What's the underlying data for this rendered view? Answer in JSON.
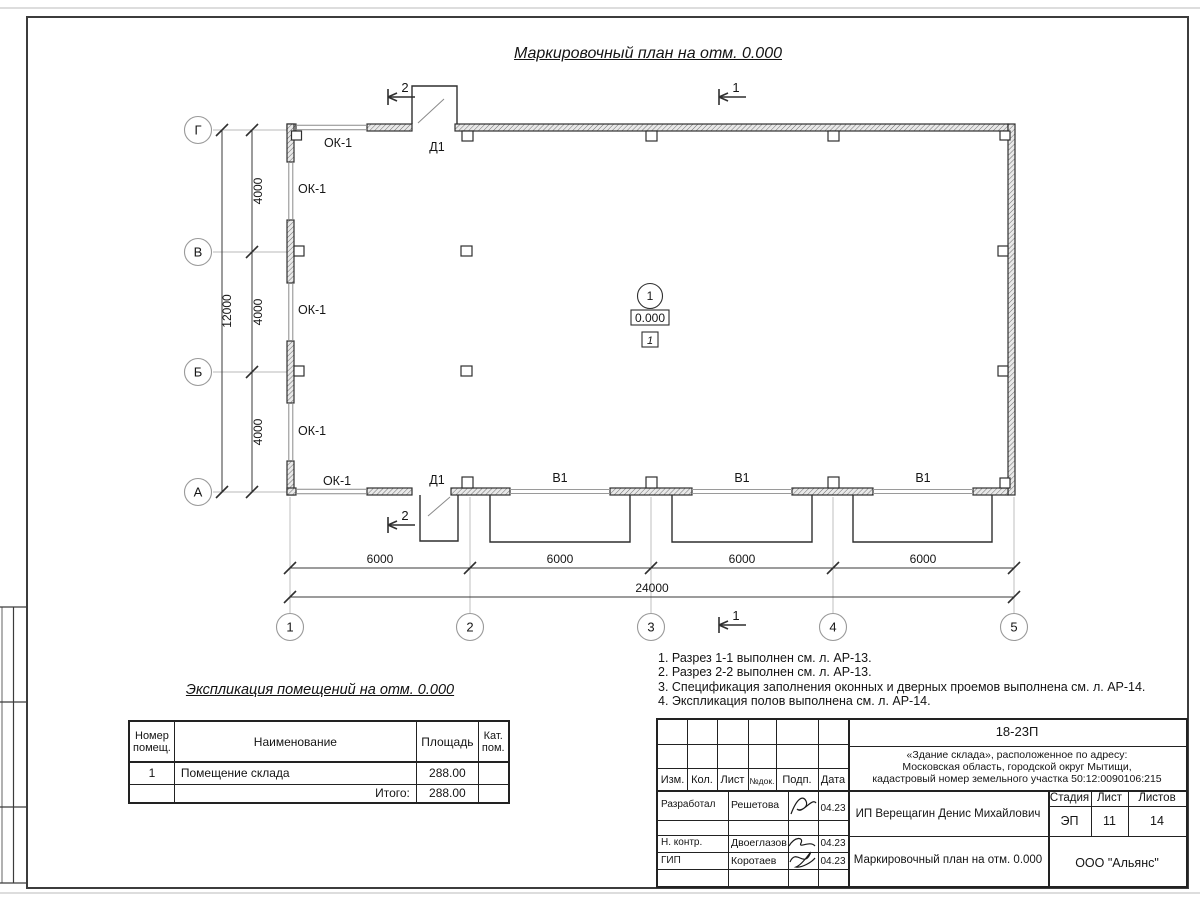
{
  "plan": {
    "title": "Маркировочный план на отм. 0.000",
    "axes_bottom": [
      "1",
      "2",
      "3",
      "4",
      "5"
    ],
    "axes_left": [
      "Г",
      "В",
      "Б",
      "А"
    ],
    "dims_bottom": [
      "6000",
      "6000",
      "6000",
      "6000"
    ],
    "dim_bottom_total": "24000",
    "dims_left": [
      "4000",
      "4000",
      "4000"
    ],
    "dim_left_total": "12000",
    "window_mark": "ОК-1",
    "door_mark": "Д1",
    "gate_mark": "В1",
    "section_mark_1": "1",
    "section_mark_2": "2",
    "room": {
      "number": "1",
      "elevation": "0.000",
      "floor_type": "1"
    }
  },
  "notes": {
    "lines": [
      "1. Разрез 1-1 выполнен см. л. АР-13.",
      "2. Разрез 2-2 выполнен см. л. АР-13.",
      "3. Спецификация заполнения оконных и дверных проемов выполнена см. л. АР-14.",
      "4. Экспликация полов выполнена см. л. АР-14."
    ]
  },
  "explication": {
    "title": "Экспликация помещений на отм. 0.000",
    "headers": {
      "number": "Номер\nпомещ.",
      "name": "Наименование",
      "area": "Площадь",
      "cat": "Кат.\nпом."
    },
    "rows": [
      {
        "number": "1",
        "name": "Помещение склада",
        "area": "288.00",
        "cat": ""
      }
    ],
    "total_label": "Итого:",
    "total_area": "288.00"
  },
  "titleblock": {
    "document_code": "18-23П",
    "object_lines": [
      "«Здание склада», расположенное по адресу:",
      "Московская область, городской округ Мытищи,",
      "кадастровый номер земельного участка 50:12:0090106:215"
    ],
    "revision_headers": [
      "Изм.",
      "Кол.",
      "Лист",
      "№док.",
      "Подп.",
      "Дата"
    ],
    "rows": [
      {
        "role": "Разработал",
        "name": "Решетова",
        "date": "04.23"
      },
      {
        "role": "Н. контр.",
        "name": "Двоеглазов",
        "date": "04.23"
      },
      {
        "role": "ГИП",
        "name": "Коротаев",
        "date": "04.23"
      }
    ],
    "client": "ИП Верещагин Денис Михайлович",
    "stage_header": "Стадия",
    "sheet_header": "Лист",
    "sheets_header": "Листов",
    "stage": "ЭП",
    "sheet_no": "11",
    "sheets_total": "14",
    "drawing_name": "Маркировочный план на отм. 0.000",
    "company": "ООО \"Альянс\""
  }
}
